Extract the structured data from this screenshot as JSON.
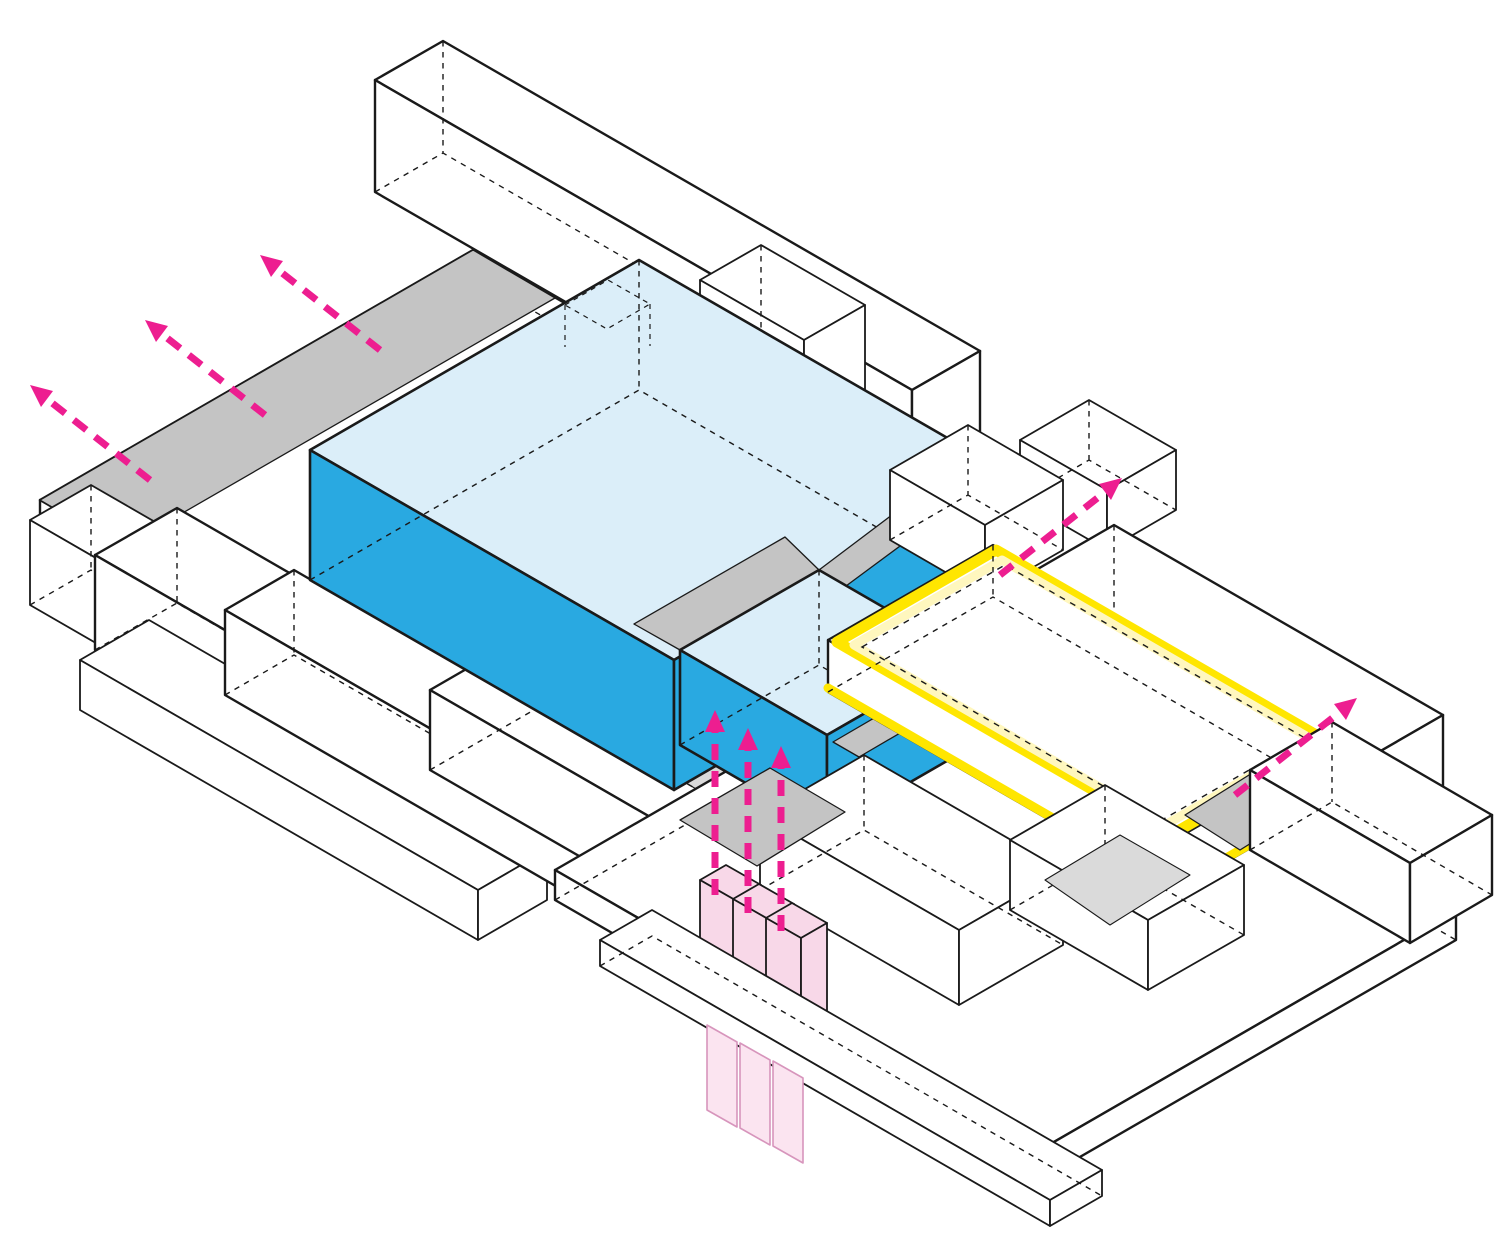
{
  "diagram": {
    "type": "axonometric-building-massing-diagram",
    "background": "#FFFFFF",
    "colors": {
      "line": "#1A1A1A",
      "white": "#FFFFFF",
      "blue": "#29A9E1",
      "blue_top": "#DBEEF9",
      "gray": "#C4C4C4",
      "gray_light": "#DADADA",
      "magenta": "#ED1E90",
      "yellow": "#FFE600",
      "yellow_pale": "#FFF7BE",
      "pink": "#F8D8E8",
      "pink_light": "#FBE4F0",
      "pink_line": "#D795BC"
    },
    "highlighted_volumes": {
      "blue_box_count": 2,
      "yellow_floor_plate_count": 1,
      "pink_column_count": 3
    },
    "arrow_groups": {
      "exit_arrows_top_left": 3,
      "rise_arrows_center": 3,
      "exit_arrow_top_right": 1,
      "exit_arrow_right": 1
    }
  }
}
